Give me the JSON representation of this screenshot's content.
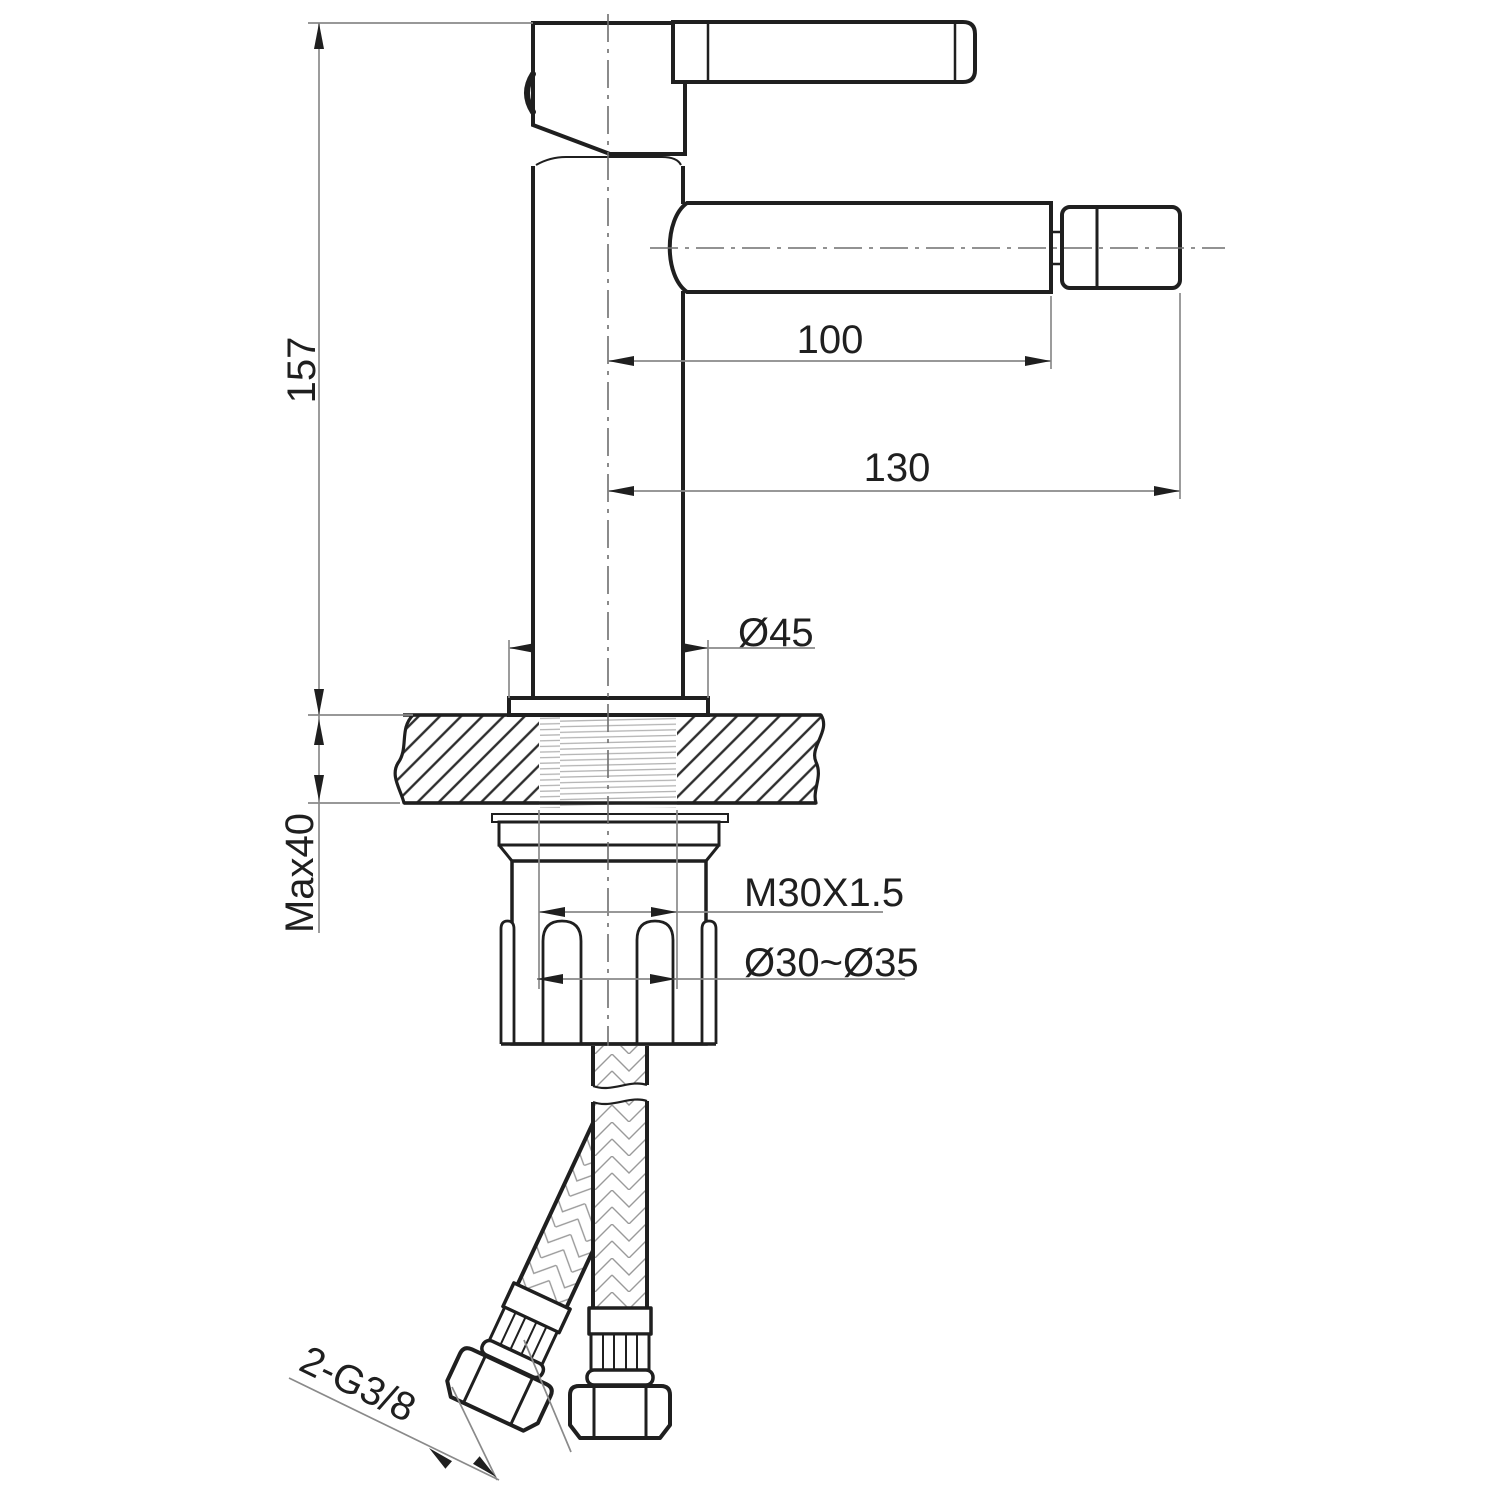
{
  "drawing": {
    "kind": "single-lever basin/bidet mixer installation drawing",
    "colors": {
      "outline": "#1f1f1f",
      "dimension_line": "#8a8a8a",
      "hatch": "#2d2d2d",
      "braid": "#9a9a9a",
      "thread": "#b3b3b3",
      "background": "#ffffff"
    },
    "dims": {
      "total_height": "157",
      "deck_thickness": "Max40",
      "spout_reach": "100",
      "overall_reach": "130",
      "base_diameter": "Ø45",
      "mounting_thread": "M30X1.5",
      "hole_diameter_range": "Ø30~Ø35",
      "hose_connection": "2-G3/8"
    }
  }
}
